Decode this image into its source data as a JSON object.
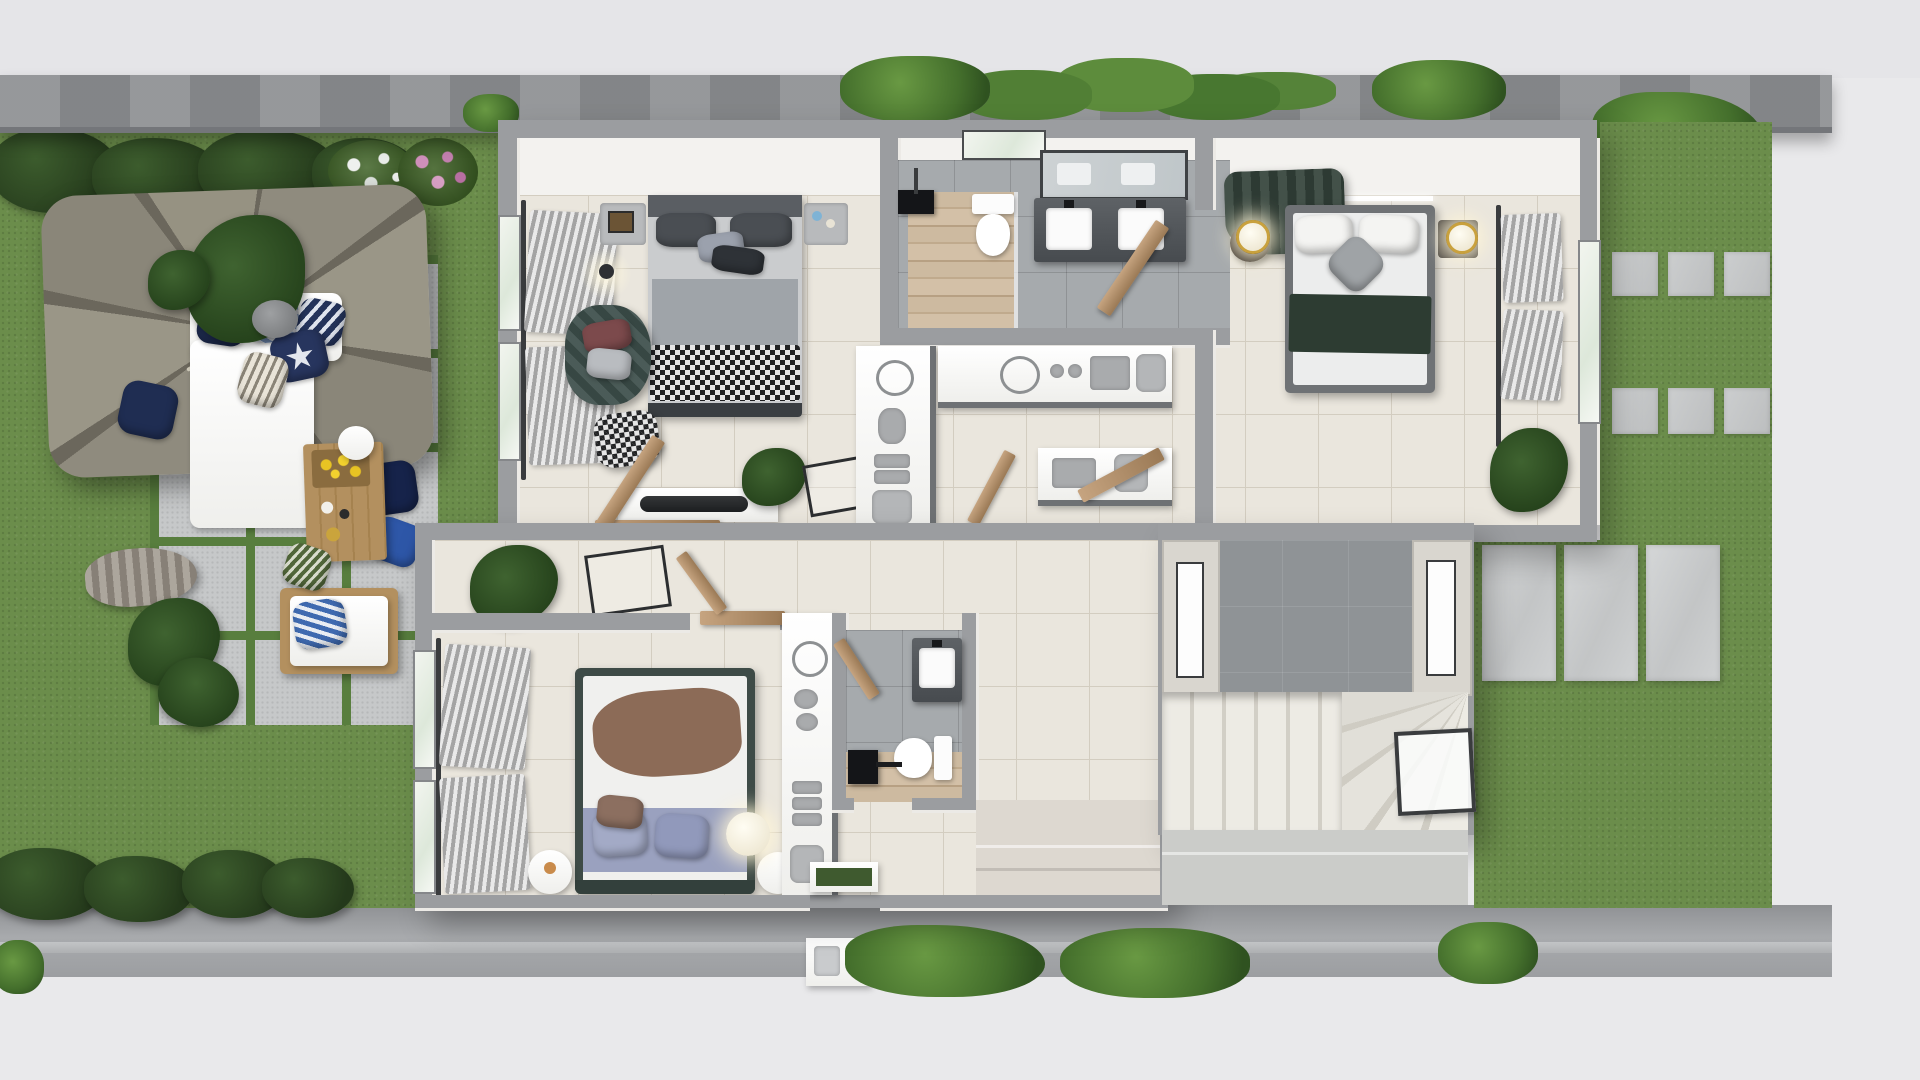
{
  "scene": {
    "type": "3d-floor-plan-render",
    "view": "top-down",
    "text_content": "none"
  },
  "palette": {
    "street": "#e9e9eb",
    "walkway": "#9fa1a4",
    "wall": "#8e9093",
    "grass": "#6b8d4b",
    "grassJoint": "#587e3e",
    "paver": "#c6c8c9",
    "houseWall": "#9b9da0",
    "wallFace": "#f3f2ef",
    "beigeWall": "#d9d6cf",
    "tile": "#eae6dd",
    "tileLine": "#d3cdc0",
    "grayTile": "#a6aaad",
    "slate": "#8f9396",
    "wood": "#c9b69b",
    "counter": "#fbfbfa",
    "darkCounter": "#54585c",
    "headboard": "#5a5e63",
    "bedGray": "#9fa4a9",
    "blanketGreen": "#2d3c32",
    "blanketBrown": "#8c6b57",
    "lavender": "#9aa1bf",
    "tealChair": "#3d4f4b",
    "navy": "#1f2d52",
    "doorTan": "#b2916c",
    "umbrella": "#8d897c",
    "leaf": "#2f4d24",
    "gold": "#c9a13d",
    "mat": "#3f5a2f",
    "lampGlow": "#fff3d6"
  },
  "house": {
    "rooms": [
      {
        "name": "bedroom-top-left",
        "furniture": [
          "double-bed-gray-checkered",
          "nightstand-left",
          "nightstand-right",
          "pendant-lamp",
          "armchair-teal",
          "pouf-checkered",
          "media-console",
          "floor-plant",
          "easel-frame",
          "window-curtains"
        ]
      },
      {
        "name": "bathroom-top",
        "fixtures": [
          "walk-in-shower-wood-floor",
          "black-shower-head",
          "toilet",
          "double-vanity",
          "mirror",
          "window"
        ]
      },
      {
        "name": "walk-in-closet",
        "fixtures": [
          "counter-vertical",
          "counter-horizontal",
          "counter-short"
        ],
        "accessories": [
          "wire-ring",
          "sunglasses",
          "stacked-boxes",
          "handbag",
          "cups",
          "tray"
        ]
      },
      {
        "name": "bedroom-master",
        "furniture": [
          "double-bed-green-blanket",
          "chaise-lounge-green",
          "nightstand-left-globe-lamp",
          "nightstand-right-globe-lamp",
          "ceiling-light-bar",
          "window-curtains",
          "monstera-plant",
          "open-door"
        ]
      },
      {
        "name": "hallway",
        "fixtures": [
          "open-wood-doors",
          "corridor"
        ]
      },
      {
        "name": "bedroom-bottom-left",
        "furniture": [
          "double-bed-brown-throw-lavender-foot",
          "round-nightstand-left",
          "round-nightstand-right",
          "floor-ball-lamp",
          "window-curtains",
          "closet-counter",
          "floor-plant",
          "easel-frame"
        ]
      },
      {
        "name": "bathroom-bottom",
        "fixtures": [
          "vanity-sink",
          "toilet",
          "black-shower-fixture",
          "wood-shower-floor"
        ]
      },
      {
        "name": "entry",
        "fixtures": [
          "front-door-gap",
          "green-doormat",
          "porch-steps"
        ]
      },
      {
        "name": "stairwell",
        "fixtures": [
          "slate-landing",
          "straight-steps",
          "winder-steps",
          "glass-panel",
          "wall-window-west",
          "wall-window-east"
        ]
      }
    ]
  },
  "garden": {
    "left": {
      "features": [
        "lawn",
        "hedge-row",
        "white-flower-bush",
        "pink-flower-bush",
        "paver-patio-grass-joints",
        "parasol",
        "outdoor-sofa-white",
        "blue-pillows",
        "starfish-pillow",
        "coffee-table-yellow-flowers",
        "lounge-chair",
        "navy-floor-pillows",
        "monstera",
        "palm-plants",
        "draped-throw"
      ]
    },
    "right": {
      "features": [
        "lawn",
        "stepping-stone-rows",
        "stone-slab-row",
        "trailing-ivy"
      ]
    },
    "boundary": {
      "features": [
        "concrete-perimeter-wall",
        "ivy-clusters",
        "rear-walkway",
        "curb",
        "utility-box",
        "street-apron"
      ]
    }
  }
}
